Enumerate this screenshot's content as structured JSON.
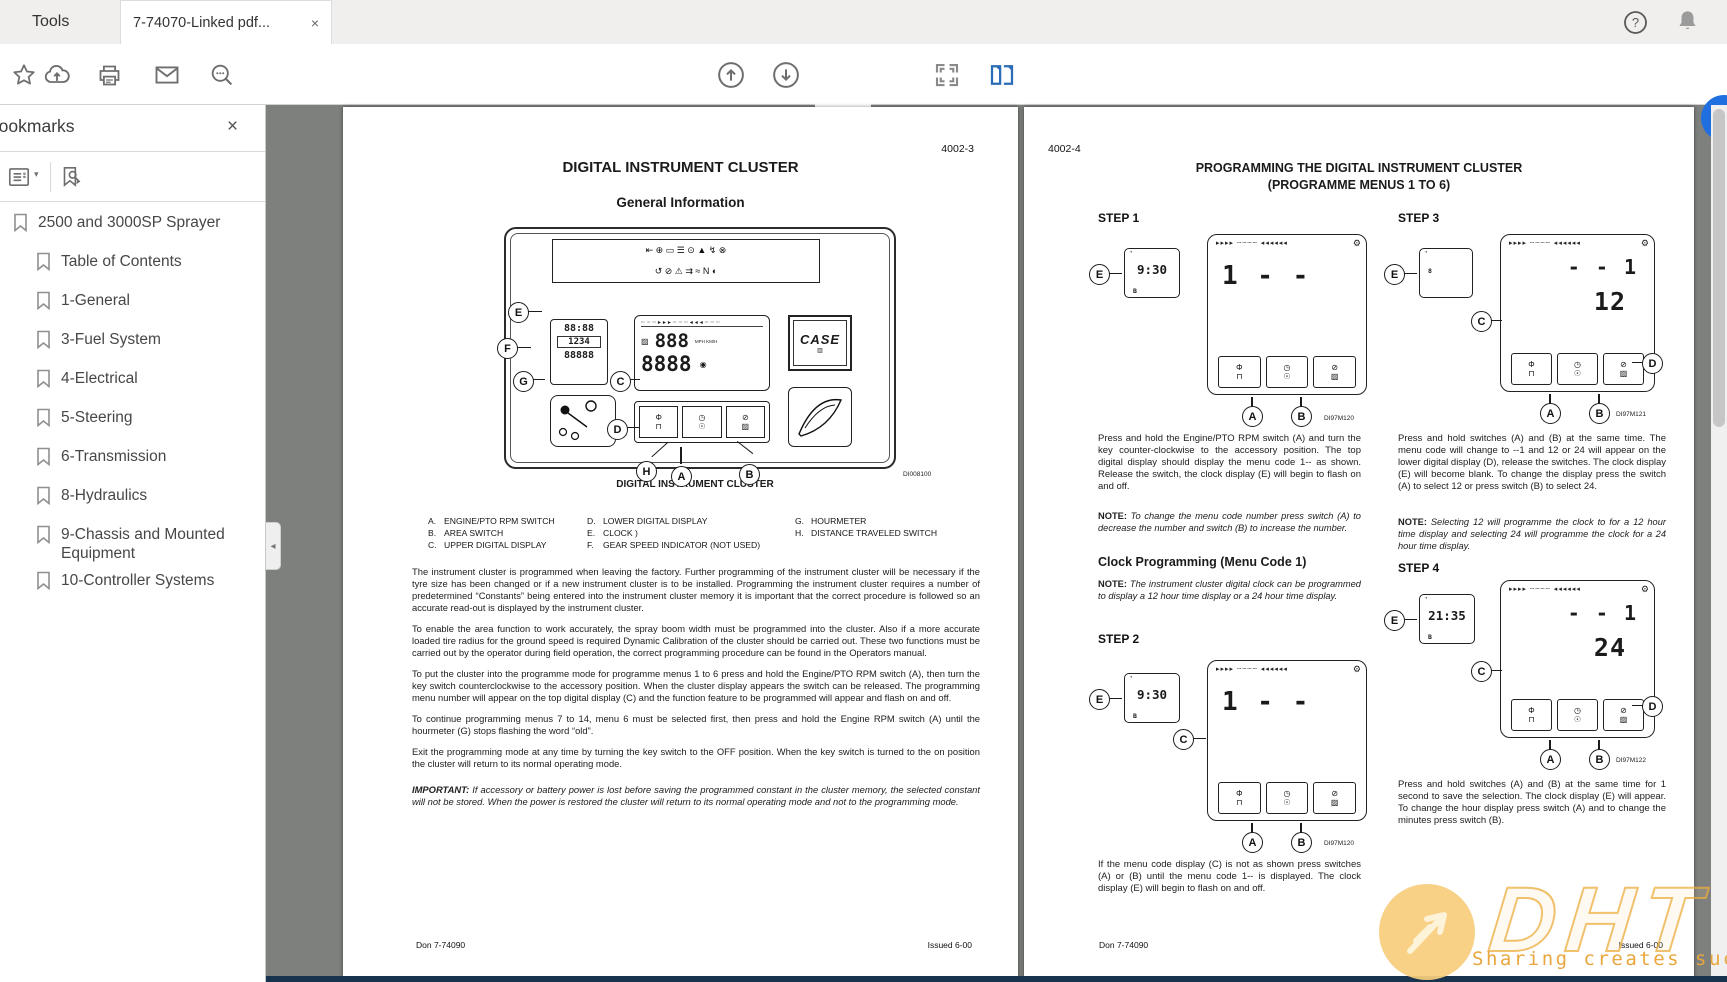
{
  "window": {
    "tabs": [
      {
        "label": "Tools"
      },
      {
        "label": "7-74070-Linked pdf..."
      }
    ]
  },
  "icons": {
    "close": "×",
    "caret_down": "▾",
    "collapse_left": "◂",
    "gear": "⚙",
    "clock_mark": "◔"
  },
  "toolbar": {
    "page_input_value": "61",
    "page_count_label": "/ 330"
  },
  "sidebar": {
    "title": "Bookmarks",
    "items": [
      {
        "label": "2500 and 3000SP Sprayer"
      },
      {
        "label": "Table of Contents"
      },
      {
        "label": "1-General"
      },
      {
        "label": "3-Fuel System"
      },
      {
        "label": "4-Electrical"
      },
      {
        "label": "5-Steering"
      },
      {
        "label": "6-Transmission"
      },
      {
        "label": "8-Hydraulics"
      },
      {
        "label": "9-Chassis and Mounted Equipment"
      },
      {
        "label": "10-Controller Systems"
      }
    ]
  },
  "letters": {
    "a": "A",
    "b": "B",
    "c": "C",
    "d": "D",
    "e": "E",
    "f": "F",
    "g": "G",
    "h": "H"
  },
  "btns": {
    "b1t": "Φ",
    "b1b": "⊓",
    "b2t": "◷",
    "b2b": "☉",
    "b3t": "⊘",
    "b3b": "▨"
  },
  "fig_strip": "▸▸▸▸ ┄┄┄┄ ◂◂◂◂◂◂",
  "left_page": {
    "page_code": "4002-3",
    "title": "DIGITAL INSTRUMENT CLUSTER",
    "subtitle": "General Information",
    "cluster": {
      "strip1": "⇤ ⊕ ▭ ☰ ⊙ ▲ ↯ ⊗",
      "strip2": "↺ ⊘ ⚠ ⇉ ≈ N ◐",
      "clock": "88:88",
      "counter": "1234",
      "odometer": "88888",
      "upper": "888",
      "lower": "8888",
      "speed_units": "MPH KM/H",
      "brand": "CASE",
      "fig_label": "DI008100",
      "caption": "DIGITAL INSTRUMENT CLUSTER"
    },
    "legend": [
      {
        "key": "A.",
        "label": "ENGINE/PTO RPM SWITCH"
      },
      {
        "key": "B.",
        "label": "AREA SWITCH"
      },
      {
        "key": "C.",
        "label": "UPPER DIGITAL DISPLAY"
      },
      {
        "key": "D.",
        "label": "LOWER DIGITAL DISPLAY"
      },
      {
        "key": "E.",
        "label": "CLOCK )"
      },
      {
        "key": "F.",
        "label": "GEAR SPEED INDICATOR (NOT USED)"
      },
      {
        "key": "G.",
        "label": "HOURMETER"
      },
      {
        "key": "H.",
        "label": "DISTANCE TRAVELED SWITCH"
      }
    ],
    "paragraphs": {
      "p1": "The instrument cluster is programmed when leaving the factory. Further programming of the instrument cluster will be necessary if the tyre size has been changed or if a new instrument cluster is to be installed. Programming the instrument cluster requires a number of predetermined “Constants” being entered into the instrument cluster memory it is important that the correct procedure is followed so an accurate read-out is displayed by the instrument cluster.",
      "p2": "To enable the area function to work accurately, the spray boom width must be programmed into the cluster. Also if a more accurate loaded tire radius for the ground speed is required Dynamic Calibration of the cluster should be carried out. These two functions must be carried out by the operator during field operation, the correct programming procedure can be found in the Operators manual.",
      "p3": "To put the cluster into the programme mode for programme menus 1 to 6 press and hold the Engine/PTO RPM switch (A), then turn the key switch counterclockwise to the accessory position. When the cluster display appears the switch can be released. The programming menu number will appear on the top digital display (C) and the function feature to be programmed will appear and flash on and off.",
      "p4": "To continue programming menus 7 to 14, menu 6 must be selected first, then press and hold the Engine RPM switch (A) until the hourmeter (G) stops flashing the word “old”.",
      "p5": "Exit the programming mode at any time by turning the key switch to the OFF position. When the key switch is turned to the on position the cluster will return to its normal operating mode."
    },
    "important_label": "IMPORTANT:",
    "important_text": "If accessory or battery power is lost before saving the programmed constant in the cluster memory, the selected constant will not be stored. When the power is restored the cluster will return to its normal operating mode and not to the programming mode.",
    "footer_left": "Don 7-74090",
    "footer_right": "Issued 6-00"
  },
  "right_page": {
    "page_code": "4002-4",
    "title_line1": "PROGRAMMING THE DIGITAL INSTRUMENT CLUSTER",
    "title_line2": "(PROGRAMME MENUS 1 TO 6)",
    "step1": {
      "label": "STEP 1",
      "clock": "9:30",
      "clock_sub": "B",
      "display": "1 - -",
      "fig_label": "DI97M120",
      "body": "Press and hold the Engine/PTO RPM switch (A) and turn the key counter-clockwise to the accessory position. The top digital display should display the menu code 1-- as shown. Release the switch, the clock display (E) will begin to flash on and off.",
      "note_label": "NOTE:",
      "note": "To change the menu code number press switch (A) to decrease the number and switch (B) to increase the number."
    },
    "clock_heading": "Clock Programming (Menu Code 1)",
    "clock_note_label": "NOTE:",
    "clock_note": "The instrument cluster digital clock can be programmed to display a 12 hour time display or a 24 hour time display.",
    "step2": {
      "label": "STEP 2",
      "clock": "9:30",
      "clock_sub": "B",
      "display": "1 - -",
      "fig_label": "DI97M120",
      "body": "If the menu code display (C) is not as shown press switches (A) or (B) until the menu code 1-- is displayed. The clock display (E) will begin to flash on and off."
    },
    "step3": {
      "label": "STEP  3",
      "clock": "8",
      "clock_sub": "",
      "display": "- - 1",
      "display2": "12",
      "fig_label": "DI97M121",
      "body": "Press and hold switches (A) and (B) at the same time. The menu code will change to --1 and 12 or 24 will appear on the lower digital display (D), release the switches. The clock display (E) will become blank. To change the display press the switch (A) to select 12 or press switch (B) to select 24.",
      "note_label": "NOTE:",
      "note": "Selecting 12 will programme the clock to for a 12 hour time display and selecting 24 will programme the clock for a 24 hour time display."
    },
    "step4": {
      "label": "STEP 4",
      "clock": "21:35",
      "clock_sub": "B",
      "display": "- - 1",
      "display2": "24",
      "fig_label": "DI97M122",
      "body": "Press and hold switches (A) and (B) at the same time for 1 second to save the selection. The clock display (E) will appear. To change the hour display press switch (A) and to change the minutes press switch (B)."
    },
    "footer_left": "Don 7-74090",
    "footer_right": "Issued 6-00"
  },
  "watermark": {
    "brand": "DHT",
    "tagline": "Sharing creates success"
  }
}
